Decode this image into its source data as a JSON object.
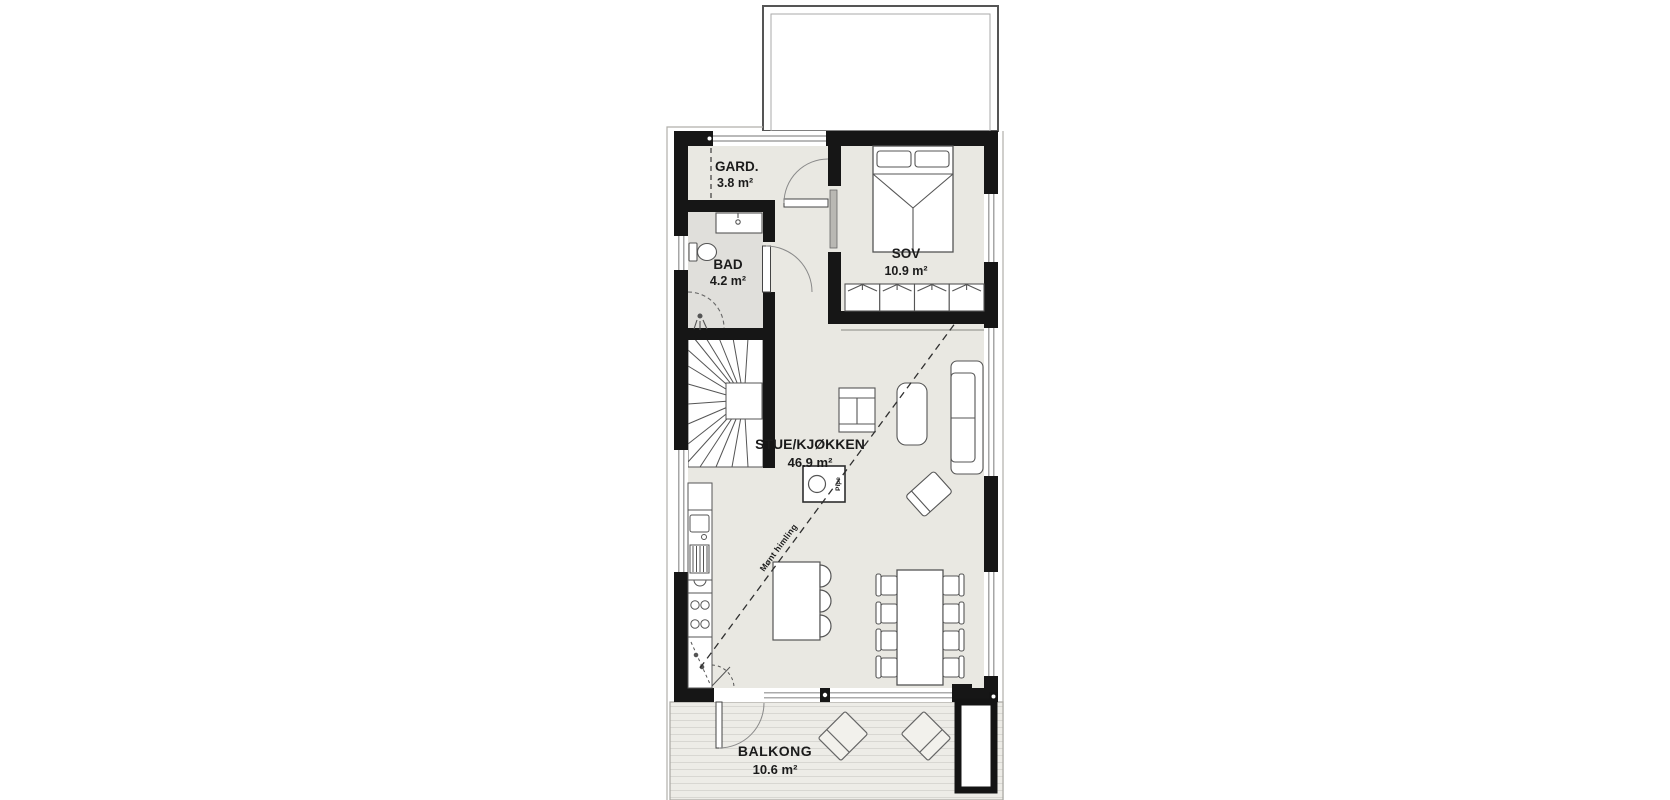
{
  "plan": {
    "rooms": [
      {
        "name": "GARD.",
        "area": "3.8 m²"
      },
      {
        "name": "BAD",
        "area": "4.2 m²"
      },
      {
        "name": "SOV",
        "area": "10.9 m²"
      },
      {
        "name": "STUE/KJØKKEN",
        "area": "46.9 m²"
      },
      {
        "name": "BALKONG",
        "area": "10.6 m²"
      }
    ],
    "annotations": {
      "ridge_line": "Mønt himling",
      "chimney": "Pipe"
    },
    "colors": {
      "wall": "#161616",
      "floor": "#e9e8e2",
      "bathroom_floor": "#e0dfdb",
      "balcony_deck": "#edece7",
      "deck_line": "#d8d7d2",
      "outline_gray": "#b0afaa",
      "furniture_stroke": "#4d4d4d"
    }
  }
}
